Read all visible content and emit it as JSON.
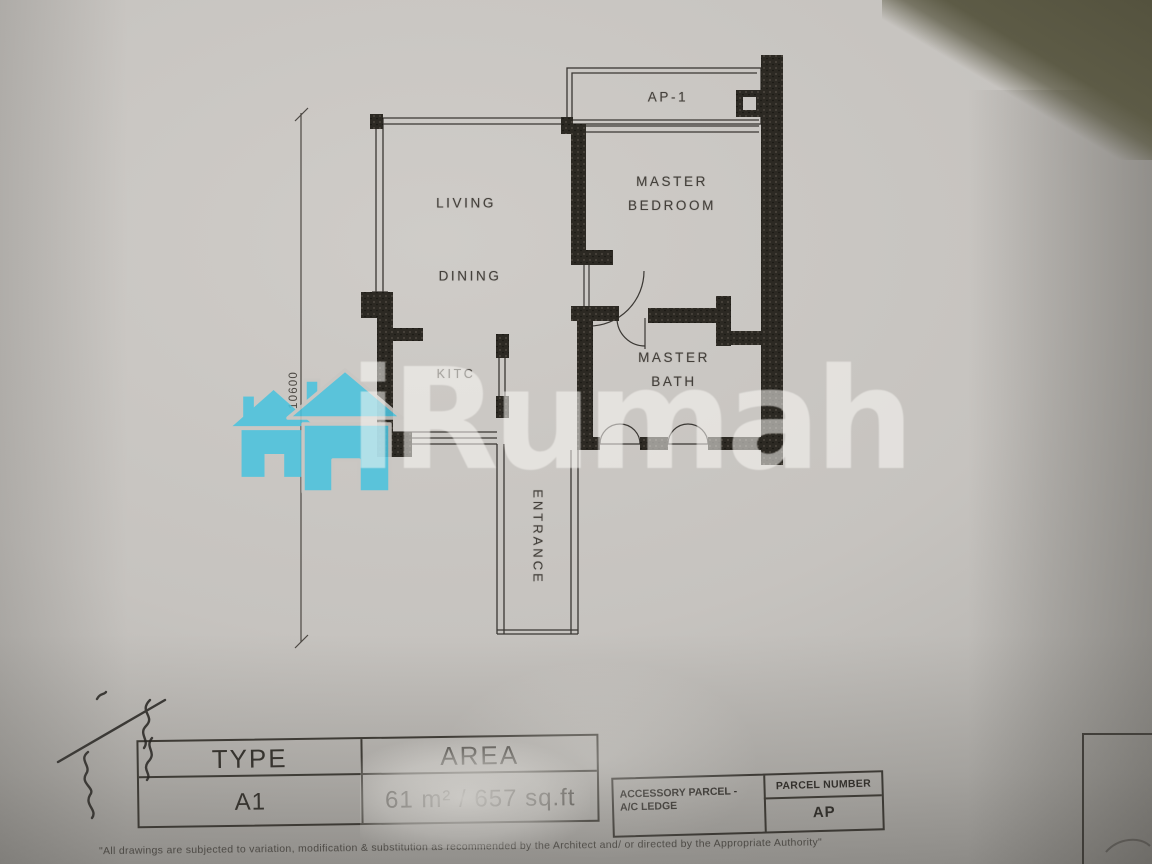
{
  "watermark": {
    "brand_text": "iRumah",
    "logo": "two-house-icon",
    "logo_color": "#4bc3de"
  },
  "floor_plan": {
    "rooms": [
      {
        "label": "LIVING"
      },
      {
        "label": "DINING"
      },
      {
        "line1": "MASTER",
        "line2": "BEDROOM"
      },
      {
        "label": "KITC"
      },
      {
        "line1": "MASTER",
        "line2": "BATH"
      },
      {
        "label": "ENTRANCE"
      },
      {
        "label": "AP-1"
      }
    ],
    "dimensions": [
      {
        "value": "10600",
        "orientation": "vertical"
      }
    ]
  },
  "info_table": {
    "headers": [
      "TYPE",
      "AREA"
    ],
    "rows": [
      {
        "type": "A1",
        "area": "61 m² / 657 sq.ft"
      }
    ]
  },
  "parcel_table": {
    "parcel_number_header": "PARCEL NUMBER",
    "accessory_parcel_line1": "ACCESSORY PARCEL -",
    "accessory_parcel_line2": "A/C LEDGE",
    "parcel_number_value": "AP"
  },
  "footnote": "\"All drawings are subjected to variation, modification & substitution as recommended by the Architect and/ or directed by the Appropriate Authority\"",
  "colors": {
    "paper": "#c6c3bf",
    "ink": "#38352f",
    "accent_cyan": "#4bc3de",
    "shadow_olive": "#5b5944"
  }
}
